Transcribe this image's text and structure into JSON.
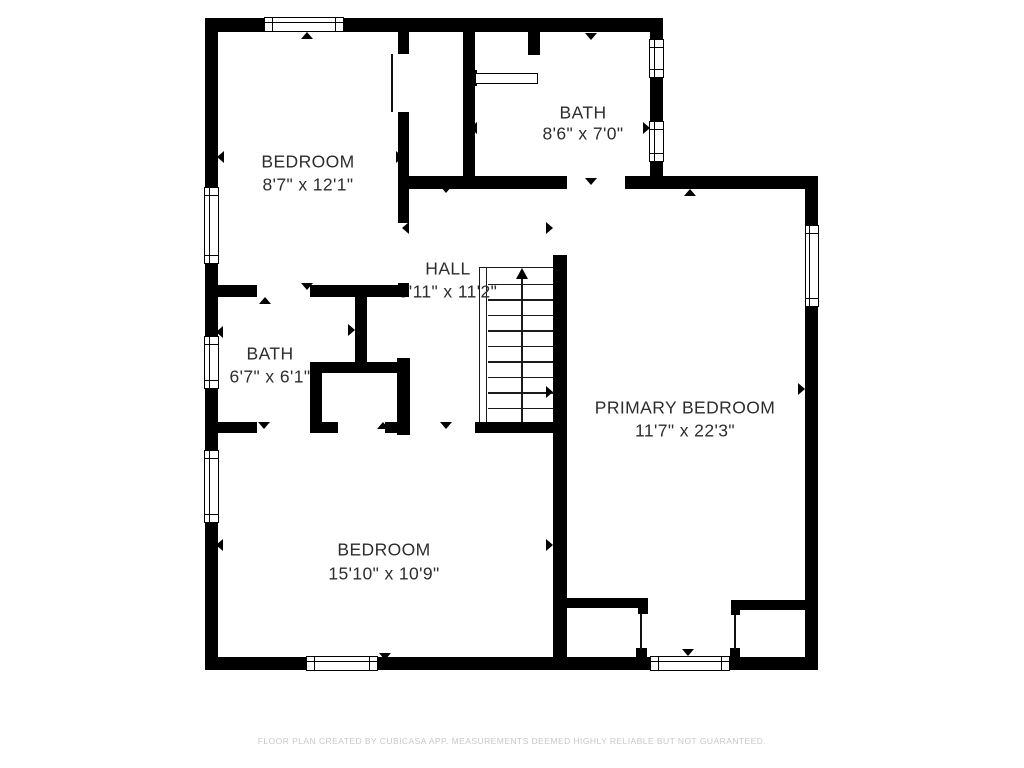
{
  "rooms": [
    {
      "name": "BEDROOM",
      "dims": "8'7\" x 12'1\"",
      "cx": 308,
      "name_cy": 162,
      "dims_cy": 185
    },
    {
      "name": "BATH",
      "dims": "8'6\" x 7'0\"",
      "cx": 583,
      "name_cy": 113,
      "dims_cy": 134
    },
    {
      "name": "HALL",
      "dims": "5'11\" x 11'2\"",
      "cx": 448,
      "name_cy": 269,
      "dims_cy": 292
    },
    {
      "name": "BATH",
      "dims": "6'7\" x 6'1\"",
      "cx": 270,
      "name_cy": 354,
      "dims_cy": 377
    },
    {
      "name": "PRIMARY BEDROOM",
      "dims": "11'7\" x 22'3\"",
      "cx": 685,
      "name_cy": 408,
      "dims_cy": 431
    },
    {
      "name": "BEDROOM",
      "dims": "15'10\" x 10'9\"",
      "cx": 384,
      "name_cy": 550,
      "dims_cy": 574
    }
  ],
  "footer": {
    "disclaimer": "FLOOR PLAN CREATED BY CUBICASA APP. MEASUREMENTS DEEMED HIGHLY RELIABLE BUT NOT GUARANTEED."
  },
  "colors": {
    "wall": "#000000",
    "background": "#ffffff",
    "label": "#2d2d2d",
    "footer_text": "#c8c8c8"
  },
  "walls": [
    {
      "name": "exterior-top-wall",
      "x": 205,
      "y": 18,
      "w": 458,
      "h": 14
    },
    {
      "name": "exterior-left-wall",
      "x": 205,
      "y": 18,
      "w": 13,
      "h": 652
    },
    {
      "name": "exterior-bath-right-wall",
      "x": 650,
      "y": 18,
      "w": 13,
      "h": 170
    },
    {
      "name": "primary-top-wall-left",
      "x": 407,
      "y": 176,
      "w": 160,
      "h": 13
    },
    {
      "name": "primary-top-wall-right",
      "x": 625,
      "y": 176,
      "w": 193,
      "h": 13
    },
    {
      "name": "exterior-right-wall",
      "x": 805,
      "y": 176,
      "w": 13,
      "h": 494
    },
    {
      "name": "exterior-bottom-wall",
      "x": 205,
      "y": 657,
      "w": 613,
      "h": 13
    },
    {
      "name": "bedroom-top-right-wall-stub",
      "x": 398,
      "y": 32,
      "w": 11,
      "h": 22
    },
    {
      "name": "bedroom-top-right-wall",
      "x": 398,
      "y": 112,
      "w": 11,
      "h": 111
    },
    {
      "name": "bedroom-top-right-wall-junction",
      "x": 398,
      "y": 283,
      "w": 11,
      "h": 14
    },
    {
      "name": "bath-left-top-wall-a",
      "x": 205,
      "y": 285,
      "w": 52,
      "h": 12
    },
    {
      "name": "bath-left-top-wall-b",
      "x": 310,
      "y": 285,
      "w": 99,
      "h": 12
    },
    {
      "name": "bath-left-tee-wall",
      "x": 355,
      "y": 297,
      "w": 12,
      "h": 66
    },
    {
      "name": "closet-top-wall",
      "x": 310,
      "y": 362,
      "w": 90,
      "h": 11
    },
    {
      "name": "closet-left-wall",
      "x": 310,
      "y": 362,
      "w": 12,
      "h": 71
    },
    {
      "name": "closet-right-wall",
      "x": 397,
      "y": 358,
      "w": 13,
      "h": 77
    },
    {
      "name": "bedroom-bottom-top-wall-a",
      "x": 205,
      "y": 422,
      "w": 52,
      "h": 11
    },
    {
      "name": "bedroom-bottom-top-wall-b",
      "x": 310,
      "y": 422,
      "w": 28,
      "h": 11
    },
    {
      "name": "bedroom-bottom-top-wall-c",
      "x": 385,
      "y": 422,
      "w": 25,
      "h": 11
    },
    {
      "name": "bedroom-bottom-top-wall-d",
      "x": 475,
      "y": 422,
      "w": 92,
      "h": 11
    },
    {
      "name": "hall-primary-divider-wall",
      "x": 553,
      "y": 255,
      "w": 14,
      "h": 403
    },
    {
      "name": "bath-top-left-wall",
      "x": 463,
      "y": 32,
      "w": 12,
      "h": 146
    },
    {
      "name": "bath-top-interior-stub",
      "x": 528,
      "y": 32,
      "w": 12,
      "h": 23
    },
    {
      "name": "bath-shelf-anchor",
      "x": 463,
      "y": 70,
      "w": 14,
      "h": 16
    },
    {
      "name": "primary-closet-left-wall",
      "x": 567,
      "y": 598,
      "w": 81,
      "h": 10
    },
    {
      "name": "primary-closet-left-jamb-top",
      "x": 638,
      "y": 605,
      "w": 10,
      "h": 9
    },
    {
      "name": "primary-closet-left-jamb-bottom",
      "x": 636,
      "y": 648,
      "w": 11,
      "h": 10
    },
    {
      "name": "primary-closet-right-wall",
      "x": 731,
      "y": 600,
      "w": 86,
      "h": 10
    },
    {
      "name": "primary-closet-right-jamb-top",
      "x": 731,
      "y": 607,
      "w": 9,
      "h": 8
    },
    {
      "name": "primary-closet-right-jamb-bottom",
      "x": 730,
      "y": 648,
      "w": 10,
      "h": 10
    }
  ],
  "door_leaves": [
    {
      "name": "bedroom-top-door-leaf",
      "x": 391,
      "y": 54,
      "w": 2,
      "h": 58
    },
    {
      "name": "primary-closet-left-door-leaf",
      "x": 640,
      "y": 614,
      "w": 2,
      "h": 36
    },
    {
      "name": "primary-closet-right-door-leaf",
      "x": 734,
      "y": 615,
      "w": 2,
      "h": 35
    }
  ],
  "fixtures": [
    {
      "name": "bath-shelf",
      "x": 475,
      "y": 73,
      "w": 63,
      "h": 11
    }
  ],
  "windows": [
    {
      "name": "window-bedroom-top",
      "x": 264,
      "y": 17,
      "w": 80,
      "h": 15,
      "o": "h"
    },
    {
      "name": "window-left-bedroom-top",
      "x": 204,
      "y": 187,
      "w": 15,
      "h": 77,
      "o": "v"
    },
    {
      "name": "window-left-bath",
      "x": 204,
      "y": 336,
      "w": 15,
      "h": 53,
      "o": "v"
    },
    {
      "name": "window-left-bedroom-bottom",
      "x": 204,
      "y": 450,
      "w": 15,
      "h": 73,
      "o": "v"
    },
    {
      "name": "window-bath-right-upper",
      "x": 649,
      "y": 39,
      "w": 15,
      "h": 39,
      "o": "v"
    },
    {
      "name": "window-bath-right-lower",
      "x": 649,
      "y": 121,
      "w": 15,
      "h": 41,
      "o": "v"
    },
    {
      "name": "window-primary-right",
      "x": 805,
      "y": 225,
      "w": 14,
      "h": 82,
      "o": "v"
    },
    {
      "name": "window-bedroom-bottom",
      "x": 306,
      "y": 656,
      "w": 72,
      "h": 15,
      "o": "h"
    },
    {
      "name": "window-primary-bottom",
      "x": 650,
      "y": 656,
      "w": 80,
      "h": 15,
      "o": "h"
    }
  ],
  "arrows": [
    {
      "name": "bedroom-top-marker-up",
      "dir": "up",
      "x": 307,
      "y": 32
    },
    {
      "name": "bedroom-top-marker-left",
      "dir": "left",
      "x": 217,
      "y": 157
    },
    {
      "name": "bedroom-top-marker-right",
      "dir": "right",
      "x": 403,
      "y": 157
    },
    {
      "name": "bedroom-top-marker-down",
      "dir": "down",
      "x": 307,
      "y": 290
    },
    {
      "name": "bath-top-marker-down",
      "dir": "down",
      "x": 591,
      "y": 40
    },
    {
      "name": "bath-top-marker-left",
      "dir": "left",
      "x": 470,
      "y": 128
    },
    {
      "name": "bath-top-marker-right",
      "dir": "right",
      "x": 650,
      "y": 128
    },
    {
      "name": "bath-top-door-arrow",
      "dir": "down",
      "x": 591,
      "y": 185
    },
    {
      "name": "hall-top-marker",
      "dir": "down",
      "x": 446,
      "y": 193
    },
    {
      "name": "bedroom-top-door-arrow",
      "dir": "left",
      "x": 402,
      "y": 228
    },
    {
      "name": "primary-door-arrow",
      "dir": "right",
      "x": 553,
      "y": 228
    },
    {
      "name": "bath-left-marker-up",
      "dir": "up",
      "x": 265,
      "y": 297
    },
    {
      "name": "bath-left-marker-left",
      "dir": "left",
      "x": 216,
      "y": 332
    },
    {
      "name": "bath-left-marker-right",
      "dir": "right",
      "x": 355,
      "y": 330
    },
    {
      "name": "bath-left-marker-down",
      "dir": "down",
      "x": 264,
      "y": 429
    },
    {
      "name": "closet-door-arrow",
      "dir": "up",
      "x": 383,
      "y": 422
    },
    {
      "name": "hall-door-arrow",
      "dir": "down",
      "x": 446,
      "y": 429
    },
    {
      "name": "hall-right-marker",
      "dir": "right",
      "x": 553,
      "y": 392
    },
    {
      "name": "primary-right-marker",
      "dir": "right",
      "x": 805,
      "y": 389
    },
    {
      "name": "primary-top-marker",
      "dir": "up",
      "x": 690,
      "y": 189
    },
    {
      "name": "primary-bottom-arrow",
      "dir": "down",
      "x": 688,
      "y": 656
    },
    {
      "name": "bedroom-bottom-marker-left",
      "dir": "left",
      "x": 216,
      "y": 545
    },
    {
      "name": "bedroom-bottom-marker-right",
      "dir": "right",
      "x": 553,
      "y": 545
    },
    {
      "name": "bedroom-bottom-marker-down",
      "dir": "down",
      "x": 385,
      "y": 660
    }
  ],
  "stairs": {
    "x": 479,
    "y": 267,
    "w": 74,
    "h": 155,
    "rail_offset": 7,
    "tread_count": 10,
    "stem_offset": 42
  }
}
